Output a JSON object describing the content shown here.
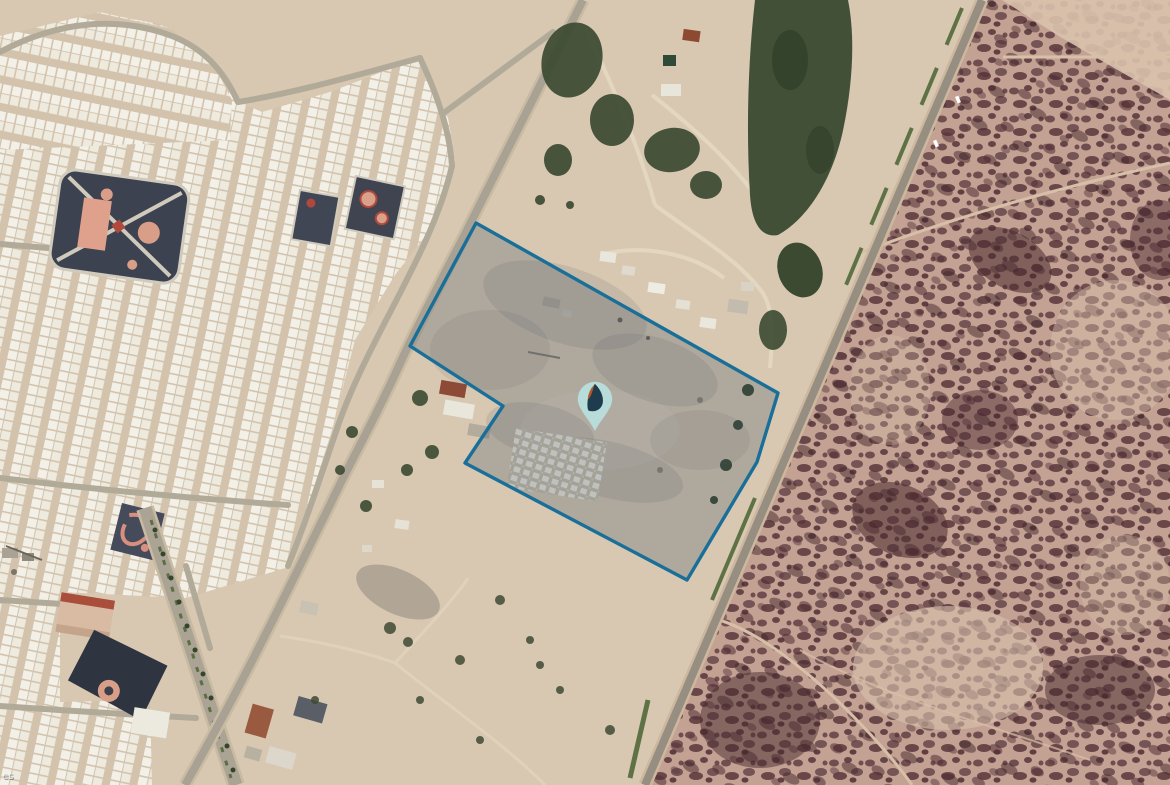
{
  "map": {
    "view_type": "satellite",
    "attribution": {
      "partial_text": "es"
    },
    "parcel": {
      "stroke_color": "#1a6f99",
      "fill_color": "rgba(52,73,94,0.25)",
      "vertices": [
        [
          476,
          223
        ],
        [
          778,
          393
        ],
        [
          757,
          462
        ],
        [
          687,
          580
        ],
        [
          465,
          463
        ],
        [
          503,
          406
        ],
        [
          410,
          346
        ]
      ]
    },
    "marker": {
      "x": 595,
      "y": 431,
      "pin_color": "#b7dcd9",
      "leaf_left_color": "#b05c2a",
      "leaf_right_color": "#1e3c4e"
    },
    "palette": {
      "desert_base": "#d8c8b2",
      "residential_ground": "#d3c3ad",
      "house_roof": "#f3f0e8",
      "street": "#b2aa99",
      "asphalt": "#a9a294",
      "scrub_base": "#c3a293",
      "scrub_dark": "#55333a",
      "vegetation_dark": "#3b4a31",
      "park_dark": "#3d4250",
      "park_pink": "#d99e87"
    }
  }
}
